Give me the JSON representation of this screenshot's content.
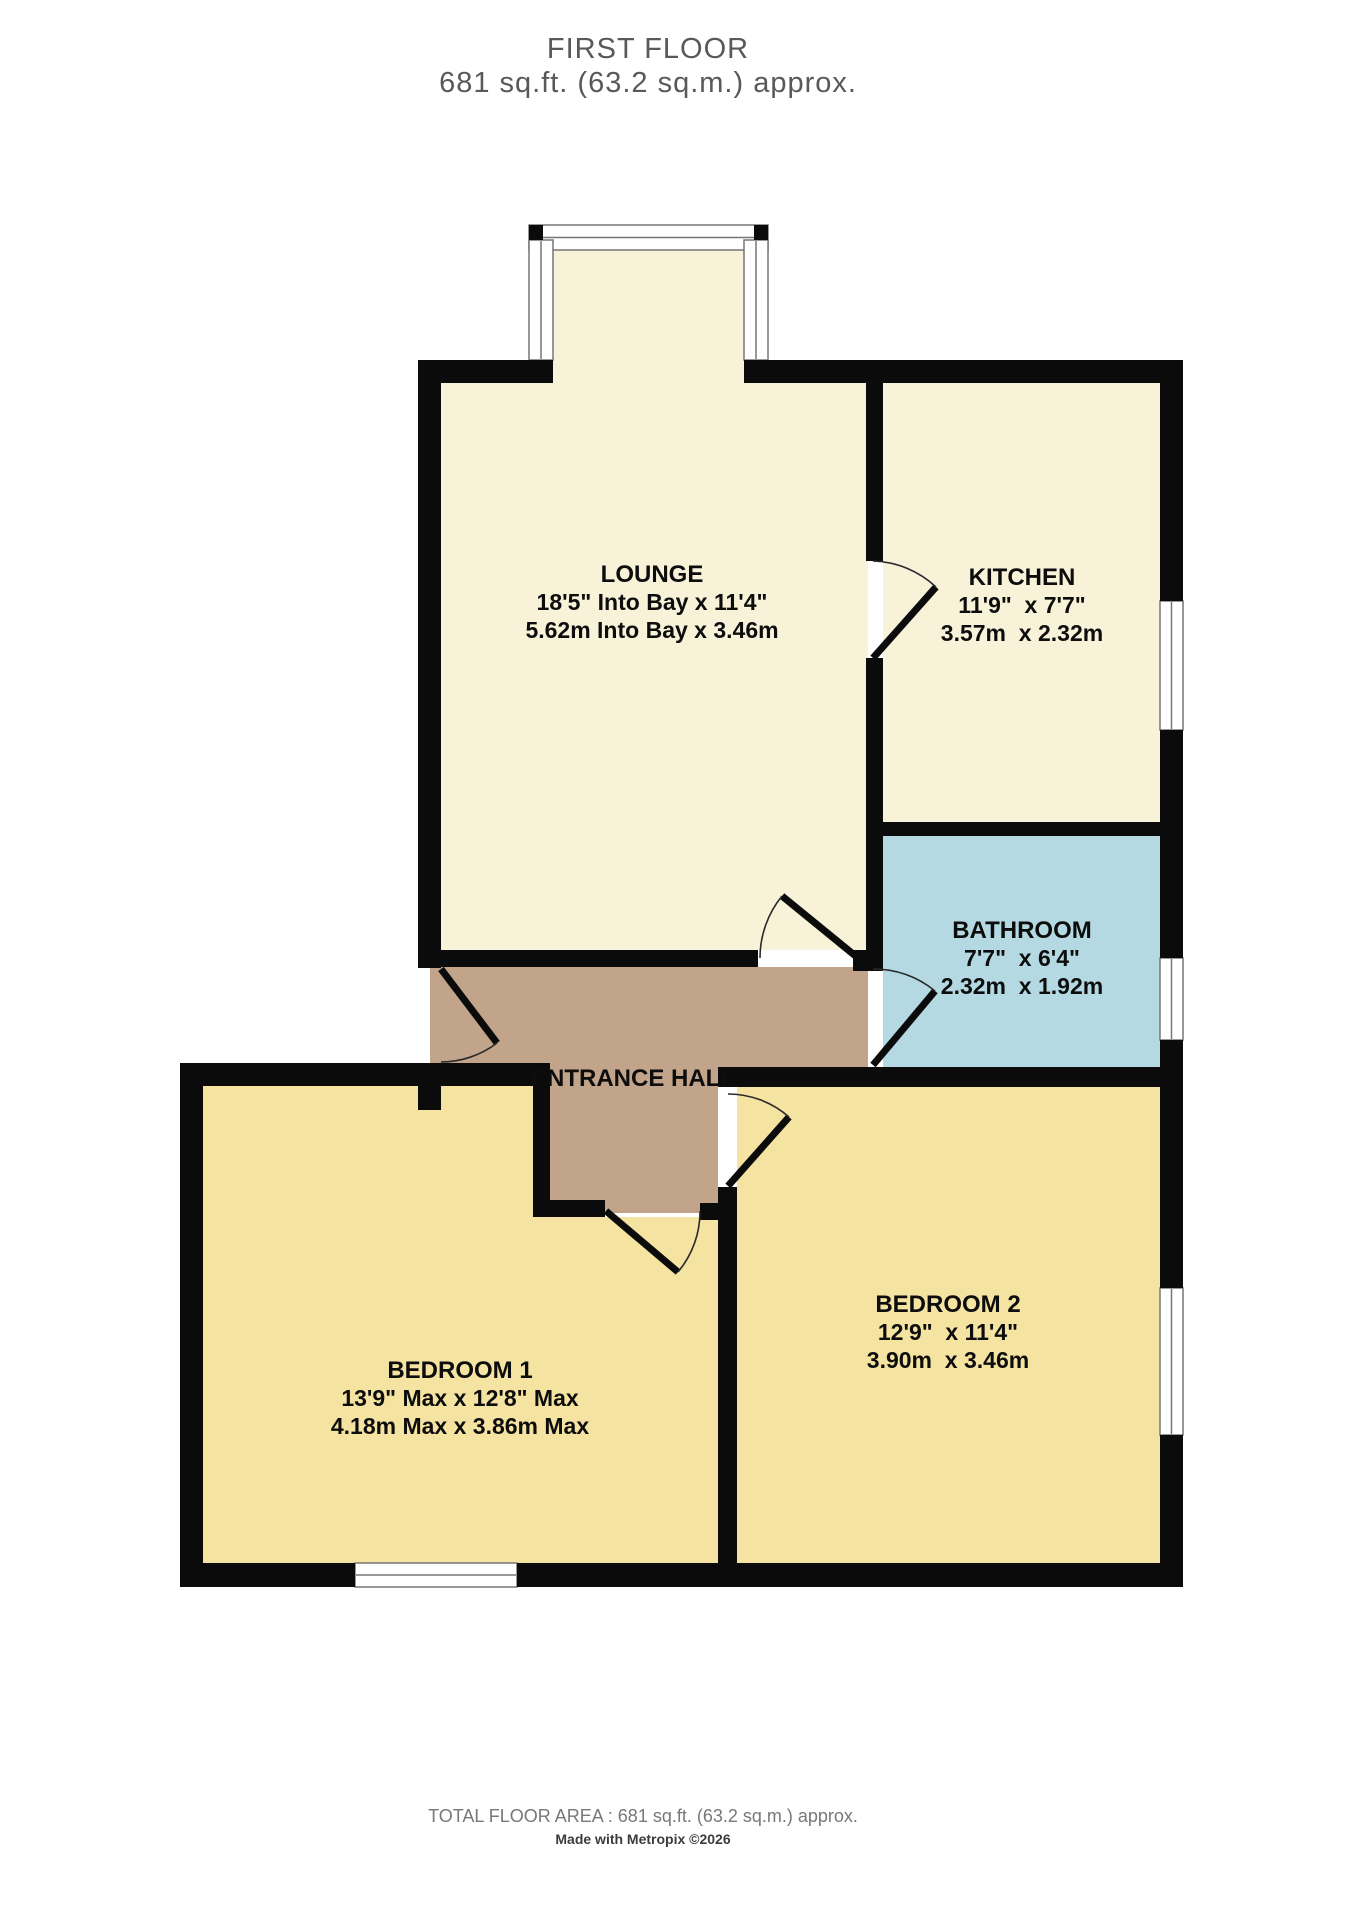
{
  "header": {
    "line1": "FIRST FLOOR",
    "line2": "681 sq.ft. (63.2 sq.m.) approx."
  },
  "rooms": {
    "lounge": {
      "name": "LOUNGE",
      "imperial": "18'5\" Into Bay x 11'4\"",
      "metric": "5.62m Into Bay x 3.46m"
    },
    "kitchen": {
      "name": "KITCHEN",
      "imperial": "11'9\"  x 7'7\"",
      "metric": "3.57m  x 2.32m"
    },
    "bathroom": {
      "name": "BATHROOM",
      "imperial": "7'7\"  x 6'4\"",
      "metric": "2.32m  x 1.92m"
    },
    "entrance_hall": {
      "name": "ENTRANCE HALL"
    },
    "bedroom1": {
      "name": "BEDROOM 1",
      "imperial": "13'9\" Max x 12'8\" Max",
      "metric": "4.18m Max x 3.86m Max"
    },
    "bedroom2": {
      "name": "BEDROOM 2",
      "imperial": "12'9\"  x 11'4\"",
      "metric": "3.90m  x 3.46m"
    }
  },
  "footer": {
    "total": "TOTAL FLOOR AREA : 681 sq.ft. (63.2 sq.m.) approx.",
    "credit": "Made with Metropix ©2026"
  },
  "colors": {
    "wall": "#0b0b0b",
    "lounge_kitchen_fill": "#f7f2d8",
    "bedroom_fill": "#f5e3a1",
    "bathroom_fill": "#b4d9e2",
    "hall_fill": "#c1a489",
    "title_text": "#58595b",
    "footer_text": "#77787b"
  }
}
